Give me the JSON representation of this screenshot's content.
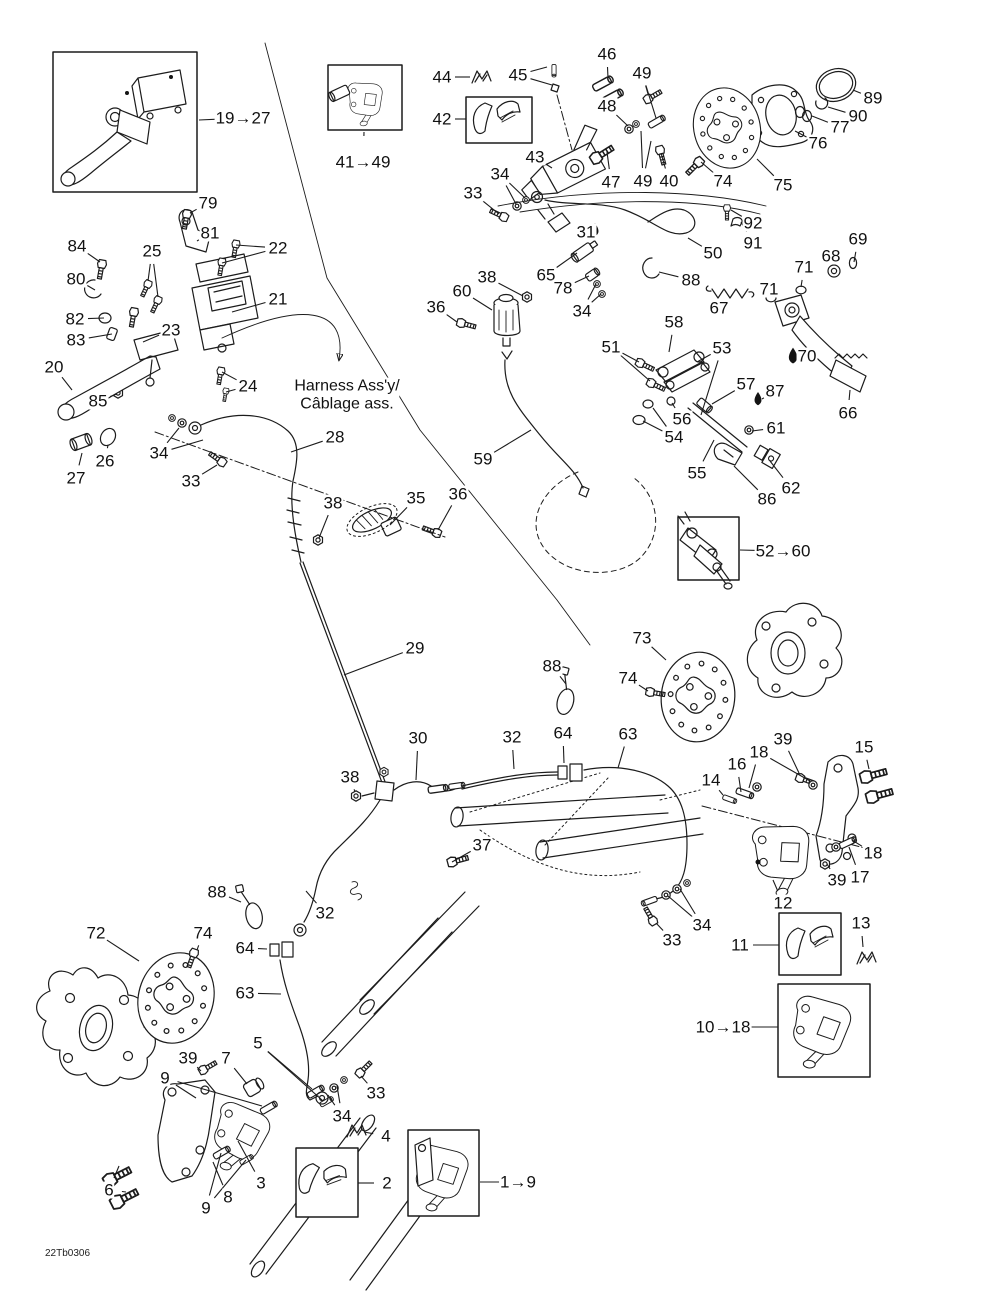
{
  "doc_code": "22Tb0306",
  "harness_note": {
    "line1": "Harness Ass'y/",
    "line2": "Câblage ass."
  },
  "diagram_title": "Hydraulic brake system exploded parts diagram",
  "colors": {
    "line": "#1c1c1c",
    "background": "#ffffff"
  },
  "callouts": [
    {
      "text": "19→27",
      "x": 243,
      "y": 118,
      "leaders": [
        [
          199,
          120
        ]
      ]
    },
    {
      "text": "79",
      "x": 208,
      "y": 203,
      "leaders": [
        [
          190,
          213
        ]
      ]
    },
    {
      "text": "81",
      "x": 210,
      "y": 233,
      "leaders": [
        [
          197,
          241
        ]
      ]
    },
    {
      "text": "22",
      "x": 278,
      "y": 248,
      "leaders": [
        [
          236,
          245
        ],
        [
          222,
          263
        ]
      ]
    },
    {
      "text": "84",
      "x": 77,
      "y": 246,
      "leaders": [
        [
          100,
          262
        ]
      ]
    },
    {
      "text": "25",
      "x": 152,
      "y": 251,
      "leaders": [
        [
          148,
          281
        ],
        [
          158,
          297
        ]
      ]
    },
    {
      "text": "80",
      "x": 76,
      "y": 279,
      "leaders": [
        [
          95,
          290
        ]
      ]
    },
    {
      "text": "82",
      "x": 75,
      "y": 319,
      "leaders": [
        [
          104,
          318
        ]
      ]
    },
    {
      "text": "83",
      "x": 76,
      "y": 340,
      "leaders": [
        [
          112,
          334
        ]
      ]
    },
    {
      "text": "23",
      "x": 171,
      "y": 330,
      "leaders": [
        [
          143,
          342
        ]
      ]
    },
    {
      "text": "21",
      "x": 278,
      "y": 299,
      "leaders": [
        [
          232,
          312
        ]
      ]
    },
    {
      "text": "24",
      "x": 248,
      "y": 386,
      "leaders": [
        [
          222,
          372
        ],
        [
          226,
          392
        ]
      ]
    },
    {
      "text": "20",
      "x": 54,
      "y": 367,
      "leaders": [
        [
          72,
          390
        ]
      ]
    },
    {
      "text": "85",
      "x": 98,
      "y": 401,
      "leaders": [
        [
          117,
          394
        ]
      ]
    },
    {
      "text": "26",
      "x": 105,
      "y": 461,
      "leaders": [
        [
          108,
          445
        ]
      ]
    },
    {
      "text": "27",
      "x": 76,
      "y": 478,
      "leaders": [
        [
          82,
          453
        ]
      ]
    },
    {
      "text": "34",
      "x": 159,
      "y": 453,
      "leaders": [
        [
          179,
          428
        ],
        [
          203,
          440
        ]
      ]
    },
    {
      "text": "33",
      "x": 191,
      "y": 481,
      "leaders": [
        [
          217,
          465
        ]
      ]
    },
    {
      "text": "28",
      "x": 335,
      "y": 437,
      "leaders": [
        [
          291,
          452
        ]
      ]
    },
    {
      "text": "38",
      "x": 333,
      "y": 503,
      "leaders": [
        [
          319,
          538
        ]
      ]
    },
    {
      "text": "35",
      "x": 416,
      "y": 498,
      "leaders": [
        [
          390,
          525
        ]
      ]
    },
    {
      "text": "36",
      "x": 458,
      "y": 494,
      "leaders": [
        [
          438,
          530
        ]
      ]
    },
    {
      "text": "41→49",
      "x": 363,
      "y": 162,
      "leaders": [
        [
          364,
          132
        ]
      ]
    },
    {
      "text": "44",
      "x": 442,
      "y": 77,
      "leaders": [
        [
          470,
          77
        ]
      ]
    },
    {
      "text": "45",
      "x": 518,
      "y": 75,
      "leaders": [
        [
          547,
          67
        ],
        [
          552,
          85
        ]
      ]
    },
    {
      "text": "46",
      "x": 607,
      "y": 54,
      "leaders": [
        [
          608,
          78
        ]
      ]
    },
    {
      "text": "49",
      "x": 642,
      "y": 73,
      "leaders": [
        [
          648,
          94
        ],
        [
          656,
          118
        ]
      ]
    },
    {
      "text": "42",
      "x": 442,
      "y": 119,
      "leaders": [
        [
          466,
          119
        ]
      ]
    },
    {
      "text": "48",
      "x": 607,
      "y": 106,
      "leaders": [
        [
          628,
          126
        ]
      ]
    },
    {
      "text": "43",
      "x": 535,
      "y": 157,
      "leaders": [
        [
          552,
          168
        ]
      ]
    },
    {
      "text": "34",
      "x": 500,
      "y": 174,
      "leaders": [
        [
          516,
          204
        ],
        [
          525,
          198
        ]
      ]
    },
    {
      "text": "33",
      "x": 473,
      "y": 193,
      "leaders": [
        [
          499,
          214
        ]
      ]
    },
    {
      "text": "47",
      "x": 611,
      "y": 182,
      "leaders": [
        [
          607,
          152
        ]
      ]
    },
    {
      "text": "49",
      "x": 643,
      "y": 181,
      "leaders": [
        [
          641,
          131
        ],
        [
          651,
          141
        ]
      ]
    },
    {
      "text": "40",
      "x": 669,
      "y": 181,
      "leaders": [
        [
          661,
          153
        ]
      ]
    },
    {
      "text": "74",
      "x": 723,
      "y": 181,
      "leaders": [
        [
          701,
          162
        ]
      ]
    },
    {
      "text": "89",
      "x": 873,
      "y": 98,
      "leaders": [
        [
          853,
          90
        ]
      ]
    },
    {
      "text": "90",
      "x": 858,
      "y": 116,
      "leaders": [
        [
          828,
          107
        ]
      ]
    },
    {
      "text": "77",
      "x": 840,
      "y": 127,
      "leaders": [
        [
          812,
          116
        ]
      ]
    },
    {
      "text": "76",
      "x": 818,
      "y": 143,
      "leaders": [
        [
          795,
          131
        ]
      ]
    },
    {
      "text": "75",
      "x": 783,
      "y": 185,
      "leaders": [
        [
          757,
          159
        ]
      ]
    },
    {
      "text": "92",
      "x": 753,
      "y": 223,
      "leaders": [
        [
          731,
          210
        ]
      ]
    },
    {
      "text": "91",
      "x": 753,
      "y": 243,
      "leaders": [
        [
          741,
          222
        ]
      ]
    },
    {
      "text": "50",
      "x": 713,
      "y": 253,
      "leaders": [
        [
          688,
          238
        ]
      ]
    },
    {
      "text": "88",
      "x": 691,
      "y": 280,
      "leaders": [
        [
          659,
          272
        ]
      ]
    },
    {
      "text": "69",
      "x": 858,
      "y": 239,
      "leaders": [
        [
          854,
          262
        ]
      ]
    },
    {
      "text": "68",
      "x": 831,
      "y": 256,
      "leaders": [
        [
          835,
          267
        ]
      ]
    },
    {
      "text": "71",
      "x": 804,
      "y": 267,
      "leaders": [
        [
          801,
          287
        ]
      ]
    },
    {
      "text": "71",
      "x": 769,
      "y": 289,
      "leaders": [
        [
          771,
          297
        ]
      ]
    },
    {
      "text": "67",
      "x": 719,
      "y": 308,
      "leaders": [
        [
          729,
          301
        ]
      ]
    },
    {
      "text": "70",
      "x": 807,
      "y": 356,
      "leaders": []
    },
    {
      "text": "66",
      "x": 848,
      "y": 413,
      "leaders": [
        [
          850,
          390
        ]
      ]
    },
    {
      "text": "58",
      "x": 674,
      "y": 322,
      "leaders": [
        [
          669,
          352
        ]
      ]
    },
    {
      "text": "31",
      "x": 586,
      "y": 232,
      "leaders": []
    },
    {
      "text": "65",
      "x": 546,
      "y": 275,
      "leaders": [
        [
          577,
          253
        ]
      ]
    },
    {
      "text": "78",
      "x": 563,
      "y": 288,
      "leaders": [
        [
          589,
          276
        ]
      ]
    },
    {
      "text": "34",
      "x": 582,
      "y": 311,
      "leaders": [
        [
          596,
          284
        ],
        [
          601,
          294
        ]
      ]
    },
    {
      "text": "38",
      "x": 487,
      "y": 277,
      "leaders": [
        [
          523,
          296
        ]
      ]
    },
    {
      "text": "60",
      "x": 462,
      "y": 291,
      "leaders": [
        [
          492,
          310
        ]
      ]
    },
    {
      "text": "36",
      "x": 436,
      "y": 307,
      "leaders": [
        [
          457,
          322
        ]
      ]
    },
    {
      "text": "51",
      "x": 611,
      "y": 347,
      "leaders": [
        [
          639,
          362
        ],
        [
          650,
          381
        ]
      ]
    },
    {
      "text": "53",
      "x": 722,
      "y": 348,
      "leaders": [
        [
          697,
          362
        ],
        [
          701,
          415
        ]
      ]
    },
    {
      "text": "57",
      "x": 746,
      "y": 384,
      "leaders": [
        [
          712,
          404
        ]
      ]
    },
    {
      "text": "87",
      "x": 775,
      "y": 391,
      "leaders": [
        [
          762,
          399
        ]
      ]
    },
    {
      "text": "56",
      "x": 682,
      "y": 419,
      "leaders": [
        [
          672,
          403
        ]
      ]
    },
    {
      "text": "54",
      "x": 674,
      "y": 437,
      "leaders": [
        [
          653,
          408
        ],
        [
          643,
          421
        ]
      ]
    },
    {
      "text": "61",
      "x": 776,
      "y": 428,
      "leaders": [
        [
          752,
          431
        ]
      ]
    },
    {
      "text": "55",
      "x": 697,
      "y": 473,
      "leaders": [
        [
          714,
          440
        ]
      ]
    },
    {
      "text": "62",
      "x": 791,
      "y": 488,
      "leaders": [
        [
          770,
          461
        ]
      ]
    },
    {
      "text": "86",
      "x": 767,
      "y": 499,
      "leaders": [
        [
          734,
          466
        ]
      ]
    },
    {
      "text": "59",
      "x": 483,
      "y": 459,
      "leaders": [
        [
          531,
          430
        ]
      ]
    },
    {
      "text": "52→60",
      "x": 783,
      "y": 551,
      "leaders": [
        [
          740,
          550
        ]
      ]
    },
    {
      "text": "29",
      "x": 415,
      "y": 648,
      "leaders": [
        [
          344,
          675
        ]
      ]
    },
    {
      "text": "88",
      "x": 552,
      "y": 666,
      "leaders": [
        [
          566,
          684
        ]
      ]
    },
    {
      "text": "73",
      "x": 642,
      "y": 638,
      "leaders": [
        [
          666,
          660
        ]
      ]
    },
    {
      "text": "74",
      "x": 628,
      "y": 678,
      "leaders": [
        [
          648,
          691
        ]
      ]
    },
    {
      "text": "30",
      "x": 418,
      "y": 738,
      "leaders": [
        [
          416,
          780
        ]
      ]
    },
    {
      "text": "32",
      "x": 512,
      "y": 737,
      "leaders": [
        [
          514,
          769
        ]
      ]
    },
    {
      "text": "64",
      "x": 563,
      "y": 733,
      "leaders": [
        [
          564,
          763
        ]
      ]
    },
    {
      "text": "63",
      "x": 628,
      "y": 734,
      "leaders": [
        [
          618,
          768
        ]
      ]
    },
    {
      "text": "38",
      "x": 350,
      "y": 777,
      "leaders": [
        [
          355,
          792
        ]
      ]
    },
    {
      "text": "37",
      "x": 482,
      "y": 845,
      "leaders": [
        [
          452,
          862
        ]
      ]
    },
    {
      "text": "39",
      "x": 783,
      "y": 739,
      "leaders": [
        [
          799,
          773
        ]
      ]
    },
    {
      "text": "18",
      "x": 759,
      "y": 752,
      "leaders": [
        [
          749,
          788
        ],
        [
          810,
          781
        ]
      ]
    },
    {
      "text": "15",
      "x": 864,
      "y": 747,
      "leaders": [
        [
          869,
          769
        ]
      ]
    },
    {
      "text": "16",
      "x": 737,
      "y": 764,
      "leaders": [
        [
          741,
          792
        ]
      ]
    },
    {
      "text": "14",
      "x": 711,
      "y": 780,
      "leaders": [
        [
          723,
          795
        ]
      ]
    },
    {
      "text": "18",
      "x": 873,
      "y": 853,
      "leaders": [
        [
          852,
          840
        ]
      ]
    },
    {
      "text": "39",
      "x": 837,
      "y": 880,
      "leaders": [
        [
          827,
          864
        ]
      ]
    },
    {
      "text": "17",
      "x": 860,
      "y": 877,
      "leaders": [
        [
          849,
          847
        ]
      ]
    },
    {
      "text": "12",
      "x": 783,
      "y": 903,
      "leaders": [
        [
          773,
          880
        ]
      ]
    },
    {
      "text": "34",
      "x": 702,
      "y": 925,
      "leaders": [
        [
          668,
          896
        ],
        [
          680,
          889
        ]
      ]
    },
    {
      "text": "33",
      "x": 672,
      "y": 940,
      "leaders": [
        [
          656,
          923
        ]
      ]
    },
    {
      "text": "11",
      "x": 740,
      "y": 945,
      "leaders": [
        [
          779,
          945
        ]
      ]
    },
    {
      "text": "13",
      "x": 861,
      "y": 923,
      "leaders": [
        [
          863,
          947
        ]
      ]
    },
    {
      "text": "10→18",
      "x": 723,
      "y": 1027,
      "leaders": [
        [
          778,
          1027
        ]
      ]
    },
    {
      "text": "88",
      "x": 217,
      "y": 892,
      "leaders": [
        [
          241,
          902
        ]
      ]
    },
    {
      "text": "72",
      "x": 96,
      "y": 933,
      "leaders": [
        [
          139,
          961
        ]
      ]
    },
    {
      "text": "74",
      "x": 203,
      "y": 933,
      "leaders": [
        [
          197,
          950
        ]
      ]
    },
    {
      "text": "32",
      "x": 325,
      "y": 913,
      "leaders": [
        [
          306,
          891
        ]
      ]
    },
    {
      "text": "64",
      "x": 245,
      "y": 948,
      "leaders": [
        [
          267,
          949
        ]
      ]
    },
    {
      "text": "63",
      "x": 245,
      "y": 993,
      "leaders": [
        [
          281,
          994
        ]
      ]
    },
    {
      "text": "39",
      "x": 188,
      "y": 1058,
      "leaders": [
        [
          201,
          1071
        ]
      ]
    },
    {
      "text": "7",
      "x": 226,
      "y": 1058,
      "leaders": [
        [
          247,
          1084
        ]
      ]
    },
    {
      "text": "5",
      "x": 258,
      "y": 1043,
      "leaders": [
        [
          312,
          1089
        ],
        [
          322,
          1100
        ]
      ]
    },
    {
      "text": "9",
      "x": 165,
      "y": 1078,
      "leaders": [
        [
          196,
          1098
        ],
        [
          262,
          1106
        ]
      ]
    },
    {
      "text": "33",
      "x": 376,
      "y": 1093,
      "leaders": [
        [
          361,
          1076
        ]
      ]
    },
    {
      "text": "34",
      "x": 342,
      "y": 1116,
      "leaders": [
        [
          337,
          1086
        ],
        [
          328,
          1095
        ]
      ]
    },
    {
      "text": "4",
      "x": 386,
      "y": 1136,
      "leaders": [
        [
          364,
          1132
        ]
      ]
    },
    {
      "text": "2",
      "x": 387,
      "y": 1183,
      "leaders": [
        [
          358,
          1183
        ]
      ]
    },
    {
      "text": "6",
      "x": 109,
      "y": 1190,
      "leaders": [
        [
          119,
          1166
        ],
        [
          126,
          1192
        ]
      ]
    },
    {
      "text": "3",
      "x": 261,
      "y": 1183,
      "leaders": [
        [
          238,
          1141
        ]
      ]
    },
    {
      "text": "8",
      "x": 228,
      "y": 1197,
      "leaders": [
        [
          213,
          1162
        ]
      ]
    },
    {
      "text": "9",
      "x": 206,
      "y": 1208,
      "leaders": [
        [
          221,
          1153
        ],
        [
          246,
          1160
        ]
      ]
    },
    {
      "text": "1→9",
      "x": 518,
      "y": 1182,
      "leaders": [
        [
          480,
          1182
        ]
      ]
    }
  ]
}
